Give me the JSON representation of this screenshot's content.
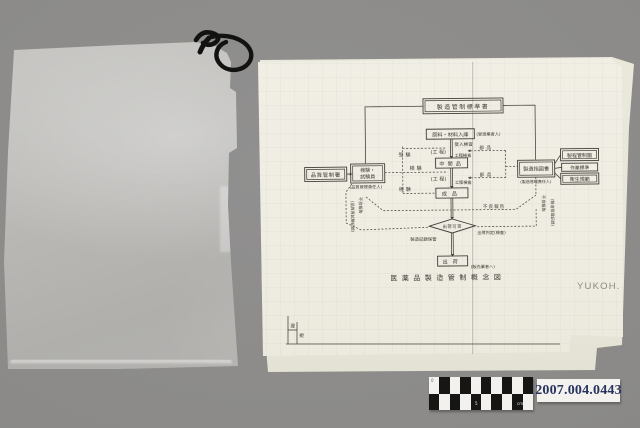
{
  "scene": {
    "background": "#8b8a88"
  },
  "catalog": {
    "number": "2007.004.0443",
    "number_color": "#28335e",
    "scale_marks": [
      "0",
      "5",
      "cm"
    ]
  },
  "document": {
    "publisher": "YUKOH.",
    "frame_labels": {
      "cell1": "理",
      "cell2": "規"
    },
    "diagram": {
      "title": "医薬品製造管制概念図",
      "nodes": {
        "standard_doc": "製造管制標準書",
        "quality_dept": "品質管制署",
        "inspector_line1": "検験・",
        "inspector_line2": "試験員",
        "inspector_note": "(品質管理責任人)",
        "material_in": "原料・材料入庫",
        "material_note": "(受渡業者人)",
        "incoming_inspection": "受入検査",
        "process1": "(工 程)",
        "process_inspection1": "工程検査",
        "parts1": "部品",
        "intermediate": "中間品",
        "process2": "(工 程)",
        "process_inspection2": "工程検査",
        "parts2": "部品",
        "finished": "成品",
        "test_label1": "受験",
        "test_label2": "検験",
        "test_label3": "検験",
        "mfg_order": "製造指図書",
        "mfg_order_note": "(製造管理責任人)",
        "doc_process_chart": "製程管制圖",
        "doc_work_standard": "作業標準",
        "doc_hygiene": "衛生規範",
        "defect_report": "不良報告",
        "left_vert1": "不良報告",
        "left_vert2": "(品質再試験記録)",
        "right_vert1": "不良報告",
        "right_vert2": "(製造管理記録)",
        "decision": "出荷可否",
        "record_note": "製造記録保管",
        "judge_note": "出荷判定(検査)",
        "ship": "出荷",
        "ship_note": "(販売業者へ)"
      }
    }
  }
}
